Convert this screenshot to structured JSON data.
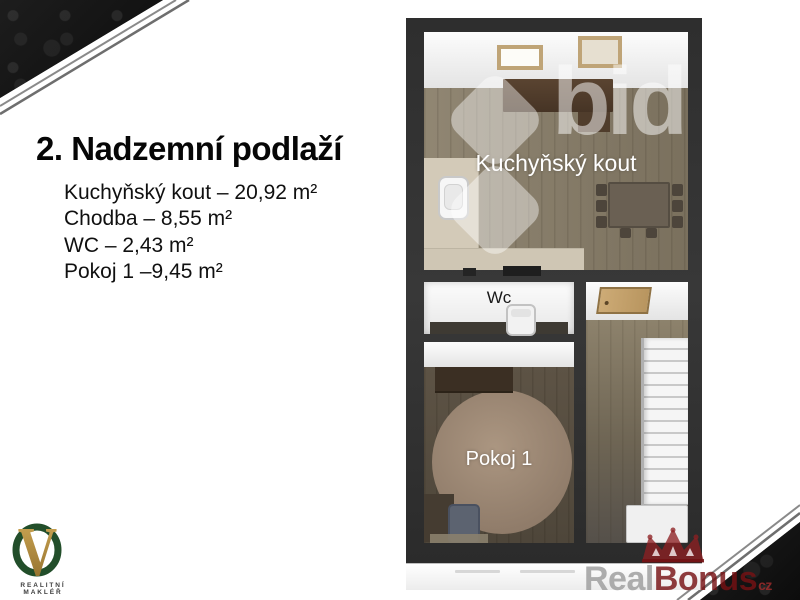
{
  "slide": {
    "title": "2. Nadzemní podlaží",
    "rooms": [
      {
        "line": "Kuchyňský kout – 20,92 m²"
      },
      {
        "line": "Chodba – 8,55 m²"
      },
      {
        "line": "WC – 2,43 m²"
      },
      {
        "line": "Pokoj 1 –9,45 m²"
      }
    ]
  },
  "floorplan": {
    "labels": {
      "kitchen": "Kuchyňský kout",
      "wc": "Wc",
      "room1": "Pokoj 1"
    }
  },
  "watermarks": {
    "bid_text": "bid",
    "realbonus": {
      "part1": "Real",
      "part2": "Bonus",
      "suffix": "cz"
    }
  },
  "logo": {
    "letter": "V",
    "caption": "REALITNÍ MAKLÉŘ"
  },
  "colors": {
    "wall_dark": "#333333",
    "floor_wood": "#887d68",
    "logo_green": "#224e2a",
    "logo_gold": "#b98f3e",
    "realbonus_red": "#7a1416",
    "corner_black": "#141414"
  }
}
